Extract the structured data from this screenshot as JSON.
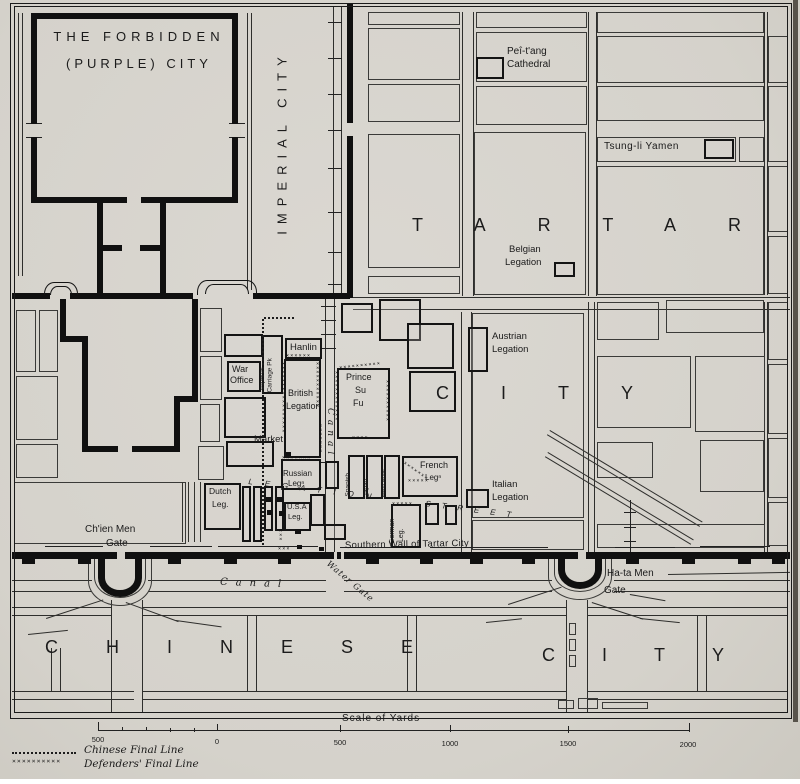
{
  "regions": {
    "forbidden_city": [
      "THE FORBIDDEN",
      "(PURPLE) CITY"
    ],
    "imperial_city": "IMPERIAL CITY",
    "tartar_city": [
      "TARTAR",
      "CITY"
    ],
    "chinese_city": [
      "CHINESE",
      "CITY"
    ]
  },
  "places": {
    "peitang": [
      "Peî-t'ang",
      "Cathedral"
    ],
    "tsungli": "Tsung-li Yamen",
    "belgian": [
      "Belgian",
      "Legation"
    ],
    "austrian": [
      "Austrian",
      "Legation"
    ],
    "italian": [
      "Italian",
      "Legation"
    ],
    "hanlin": "Hanlin",
    "war_office": [
      "War",
      "Office"
    ],
    "imperial_carriage": [
      "Imperial",
      "Carriage Pk"
    ],
    "british": [
      "British",
      "Legation"
    ],
    "market": "Market",
    "russian": [
      "Russian",
      "Legⁿ"
    ],
    "dutch": [
      "Dutch",
      "Leg."
    ],
    "usa": [
      "U.S.A",
      "Leg."
    ],
    "spanish": "Spanish",
    "japan": "Japan.",
    "pekin_hotel": "Pekin Hotel",
    "prince_su_fu": [
      "Prince",
      "Su",
      "Fu"
    ],
    "french": [
      "French",
      "Legⁿ"
    ],
    "german": [
      "German",
      "Leg."
    ]
  },
  "streets": {
    "legation_street": [
      "LEGATION",
      "STREET"
    ],
    "canal_vertical": "Canal",
    "canal_chinese": "Canal",
    "water_gate": "Water Gate",
    "southern_wall": "Southern Wall of Tartar City"
  },
  "gates": {
    "chien_men": [
      "Ch'ien Men",
      "Gate"
    ],
    "hata_men": [
      "Ha-ta Men",
      "Gate"
    ]
  },
  "scale": {
    "title": "Scale of Yards",
    "ticks": [
      "500",
      "0",
      "500",
      "1000",
      "1500",
      "2000"
    ]
  },
  "legend": {
    "chinese_line": {
      "label": "Chinese Final Line"
    },
    "defenders_line": {
      "sample": "××××××××××",
      "label": "Defenders' Final Line"
    }
  }
}
